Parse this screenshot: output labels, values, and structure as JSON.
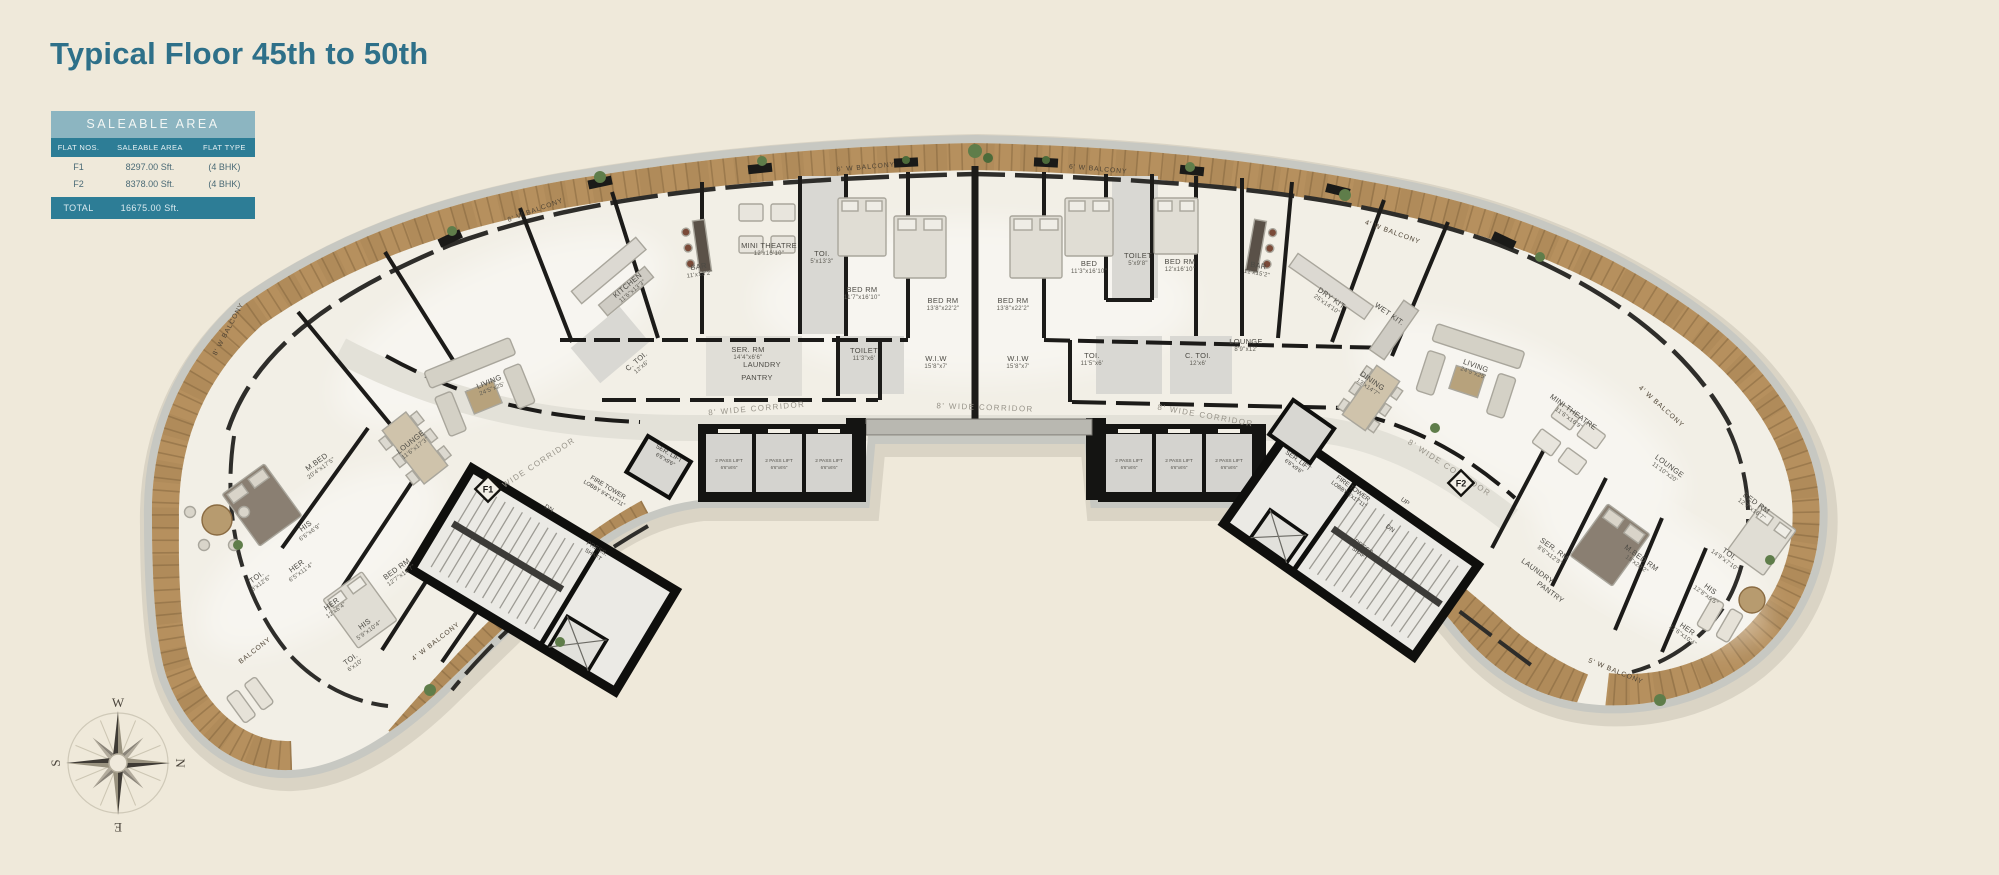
{
  "page": {
    "title": "Typical Floor 45th to 50th",
    "background_color": "#efe9da",
    "accent_color": "#2e7089",
    "wood_color": "#b08b5a",
    "wall_color": "#161513"
  },
  "saleable_table": {
    "title": "SALEABLE AREA",
    "columns": [
      "FLAT NOS.",
      "SALEABLE AREA",
      "FLAT TYPE"
    ],
    "rows": [
      {
        "flat": "F1",
        "area": "8297.00 Sft.",
        "type": "(4 BHK)"
      },
      {
        "flat": "F2",
        "area": "8378.00 Sft.",
        "type": "(4 BHK)"
      }
    ],
    "total_label": "TOTAL",
    "total_value": "16675.00 Sft.",
    "colors": {
      "band_bg": "#8cb5c1",
      "header_bg": "#2d7d96",
      "row_text": "#4a6a76"
    }
  },
  "compass": {
    "top": "W",
    "right": "N",
    "bottom": "E",
    "left": "S"
  },
  "floor_plan": {
    "flat_markers": [
      {
        "label": "F1",
        "x": 488,
        "y": 489
      },
      {
        "label": "F2",
        "x": 1461,
        "y": 483
      }
    ],
    "corridor_labels": [
      {
        "t": "8' WIDE CORRIDOR",
        "x": 535,
        "y": 468,
        "r": -33
      },
      {
        "t": "8' WIDE CORRIDOR",
        "x": 757,
        "y": 411,
        "r": -5
      },
      {
        "t": "8' WIDE CORRIDOR",
        "x": 985,
        "y": 410,
        "r": 2
      },
      {
        "t": "8' WIDE CORRIDOR",
        "x": 1205,
        "y": 418,
        "r": 10
      },
      {
        "t": "8' WIDE CORRIDOR",
        "x": 1448,
        "y": 470,
        "r": 33
      }
    ],
    "balcony_labels": [
      {
        "t": "8' W BALCONY",
        "x": 536,
        "y": 212,
        "r": -20
      },
      {
        "t": "6' W BALCONY",
        "x": 866,
        "y": 169,
        "r": -5
      },
      {
        "t": "6' W BALCONY",
        "x": 1098,
        "y": 171,
        "r": 5
      },
      {
        "t": "4' W BALCONY",
        "x": 1392,
        "y": 234,
        "r": 20
      },
      {
        "t": "4' W BALCONY",
        "x": 1660,
        "y": 408,
        "r": 42
      },
      {
        "t": "4' W BALCONY",
        "x": 437,
        "y": 643,
        "r": -38
      },
      {
        "t": "8' W BALCONY",
        "x": 230,
        "y": 330,
        "r": -62
      },
      {
        "t": "5' W BALCONY",
        "x": 1615,
        "y": 673,
        "r": 22
      },
      {
        "t": "BALCONY",
        "x": 256,
        "y": 652,
        "r": -38
      }
    ],
    "room_labels": [
      {
        "t": "LIVING",
        "d": "24'5\"x25'",
        "x": 490,
        "y": 384,
        "r": -22
      },
      {
        "t": "LOUNGE",
        "d": "11'6\"x17'3\"",
        "x": 412,
        "y": 444,
        "r": -38
      },
      {
        "t": "M.BED",
        "d": "20'4\"x17'5\"",
        "x": 318,
        "y": 464,
        "r": -36
      },
      {
        "t": "HIS",
        "d": "6'6\"x6'9\"",
        "x": 307,
        "y": 528,
        "r": -36
      },
      {
        "t": "HER",
        "d": "6'5\"x11'4\"",
        "x": 298,
        "y": 568,
        "r": -36
      },
      {
        "t": "TOI.",
        "d": "8'x12'6\"",
        "x": 258,
        "y": 579,
        "r": -36
      },
      {
        "t": "HER",
        "d": "12'x6'4\"",
        "x": 333,
        "y": 606,
        "r": -36
      },
      {
        "t": "HIS",
        "d": "5'9\"x10'4\"",
        "x": 366,
        "y": 626,
        "r": -36
      },
      {
        "t": "TOI.",
        "d": "6'x10'",
        "x": 352,
        "y": 661,
        "r": -36
      },
      {
        "t": "BED RM",
        "d": "12'7\"x16'7\"",
        "x": 398,
        "y": 571,
        "r": -36
      },
      {
        "t": "KITCHEN",
        "d": "11'6\"x13'3\"",
        "x": 629,
        "y": 287,
        "r": -40
      },
      {
        "t": "BAR",
        "d": "11'x13'2\"",
        "x": 699,
        "y": 269,
        "r": -8
      },
      {
        "t": "MINI THEATRE",
        "d": "12'x16'10\"",
        "x": 769,
        "y": 248,
        "r": 0
      },
      {
        "t": "TOI.",
        "d": "5'x13'3\"",
        "x": 822,
        "y": 256,
        "r": 0
      },
      {
        "t": "BED RM",
        "d": "11'7\"x16'10\"",
        "x": 862,
        "y": 292,
        "r": 0
      },
      {
        "t": "SER. RM",
        "d": "14'4\"x6'6\"",
        "x": 748,
        "y": 352,
        "r": 0
      },
      {
        "t": "LAUNDRY",
        "d": "",
        "x": 762,
        "y": 367,
        "r": 0
      },
      {
        "t": "PANTRY",
        "d": "",
        "x": 757,
        "y": 380,
        "r": 0
      },
      {
        "t": "TOILET",
        "d": "11'3\"x6'",
        "x": 864,
        "y": 353,
        "r": 0
      },
      {
        "t": "C. TOI.",
        "d": "12'x6'",
        "x": 638,
        "y": 363,
        "r": -40
      },
      {
        "t": "BED RM",
        "d": "13'8\"x22'2\"",
        "x": 943,
        "y": 303,
        "r": 0
      },
      {
        "t": "W.I.W",
        "d": "15'8\"x7'",
        "x": 936,
        "y": 361,
        "r": 0
      },
      {
        "t": "BED RM",
        "d": "13'8\"x22'2\"",
        "x": 1013,
        "y": 303,
        "r": 0
      },
      {
        "t": "W.I.W",
        "d": "15'8\"x7'",
        "x": 1018,
        "y": 361,
        "r": 0
      },
      {
        "t": "BED",
        "d": "11'3\"x16'10\"",
        "x": 1089,
        "y": 266,
        "r": 0
      },
      {
        "t": "TOILET",
        "d": "5'x9'8\"",
        "x": 1138,
        "y": 258,
        "r": 0
      },
      {
        "t": "TOI.",
        "d": "11'5\"x6'",
        "x": 1092,
        "y": 358,
        "r": 0
      },
      {
        "t": "C. TOI.",
        "d": "12'x6'",
        "x": 1198,
        "y": 358,
        "r": 0
      },
      {
        "t": "BED RM",
        "d": "12'x16'10\"",
        "x": 1180,
        "y": 264,
        "r": 0
      },
      {
        "t": "BAR",
        "d": "11'x15'2\"",
        "x": 1258,
        "y": 268,
        "r": 10
      },
      {
        "t": "LOUNGE",
        "d": "8'9\"x12'",
        "x": 1246,
        "y": 344,
        "r": 0
      },
      {
        "t": "DRY KIT",
        "d": "25'x14'10\"",
        "x": 1330,
        "y": 300,
        "r": 35
      },
      {
        "t": "WET KIT.",
        "d": "",
        "x": 1388,
        "y": 316,
        "r": 35
      },
      {
        "t": "DINING",
        "d": "13'x14'7\"",
        "x": 1371,
        "y": 383,
        "r": 35
      },
      {
        "t": "LIVING",
        "d": "24'5\"x25'",
        "x": 1475,
        "y": 368,
        "r": 20
      },
      {
        "t": "MINI THEATRE",
        "d": "11'6\"x16'9\"",
        "x": 1572,
        "y": 414,
        "r": 36
      },
      {
        "t": "LOUNGE",
        "d": "11'10\"x20'",
        "x": 1668,
        "y": 468,
        "r": 36
      },
      {
        "t": "SER. RM",
        "d": "8'6\"x12'8\"",
        "x": 1553,
        "y": 551,
        "r": 36
      },
      {
        "t": "LAUNDRY",
        "d": "",
        "x": 1536,
        "y": 573,
        "r": 36
      },
      {
        "t": "PANTRY",
        "d": "",
        "x": 1549,
        "y": 594,
        "r": 36
      },
      {
        "t": "M.BED RM",
        "d": "18'x20'2\"",
        "x": 1640,
        "y": 560,
        "r": 36
      },
      {
        "t": "TOI.",
        "d": "14'9\"x7'10\"",
        "x": 1728,
        "y": 556,
        "r": 36
      },
      {
        "t": "HIS",
        "d": "12'8\"x6'5\"",
        "x": 1709,
        "y": 591,
        "r": 36
      },
      {
        "t": "HER",
        "d": "11'6\"x10'4\"",
        "x": 1686,
        "y": 631,
        "r": 36
      },
      {
        "t": "BED RM",
        "d": "12'7\"x16'7\"",
        "x": 1755,
        "y": 505,
        "r": 36
      }
    ],
    "core_labels": [
      {
        "t": "FIRE TOWER",
        "d": "LOBBY 9'4\"x17'11\"",
        "x": 607,
        "y": 489,
        "r": 31
      },
      {
        "t": "PRESS.",
        "d": "SHAFT",
        "x": 596,
        "y": 550,
        "r": 31
      },
      {
        "t": "DN",
        "d": "",
        "x": 548,
        "y": 510,
        "r": 31
      },
      {
        "t": "SER. LIFT",
        "d": "6'6\"x9'6\"",
        "x": 668,
        "y": 455,
        "r": 31
      },
      {
        "t": "FIRE TOWER",
        "d": "LOBBY 5'x17'11\"",
        "x": 1352,
        "y": 490,
        "r": 36
      },
      {
        "t": "PRESS.",
        "d": "SHAFT",
        "x": 1363,
        "y": 549,
        "r": 36
      },
      {
        "t": "UP",
        "d": "",
        "x": 1404,
        "y": 503,
        "r": 36
      },
      {
        "t": "DN",
        "d": "",
        "x": 1389,
        "y": 530,
        "r": 36
      },
      {
        "t": "SER. LIFT",
        "d": "6'6\"x9'6\"",
        "x": 1297,
        "y": 462,
        "r": 36
      }
    ],
    "lift_labels": [
      {
        "t": "2 PASS LIFT",
        "d": "6'6\"x6'6\"",
        "x": 729,
        "y": 462,
        "r": 0
      },
      {
        "t": "2 PASS LIFT",
        "d": "6'6\"x6'6\"",
        "x": 779,
        "y": 462,
        "r": 0
      },
      {
        "t": "2 PASS LIFT",
        "d": "6'6\"x6'6\"",
        "x": 829,
        "y": 462,
        "r": 0
      },
      {
        "t": "2 PASS LIFT",
        "d": "6'6\"x6'6\"",
        "x": 1129,
        "y": 462,
        "r": 0
      },
      {
        "t": "2 PASS LIFT",
        "d": "6'6\"x6'6\"",
        "x": 1179,
        "y": 462,
        "r": 0
      },
      {
        "t": "2 PASS LIFT",
        "d": "6'6\"x6'6\"",
        "x": 1229,
        "y": 462,
        "r": 0
      }
    ]
  }
}
